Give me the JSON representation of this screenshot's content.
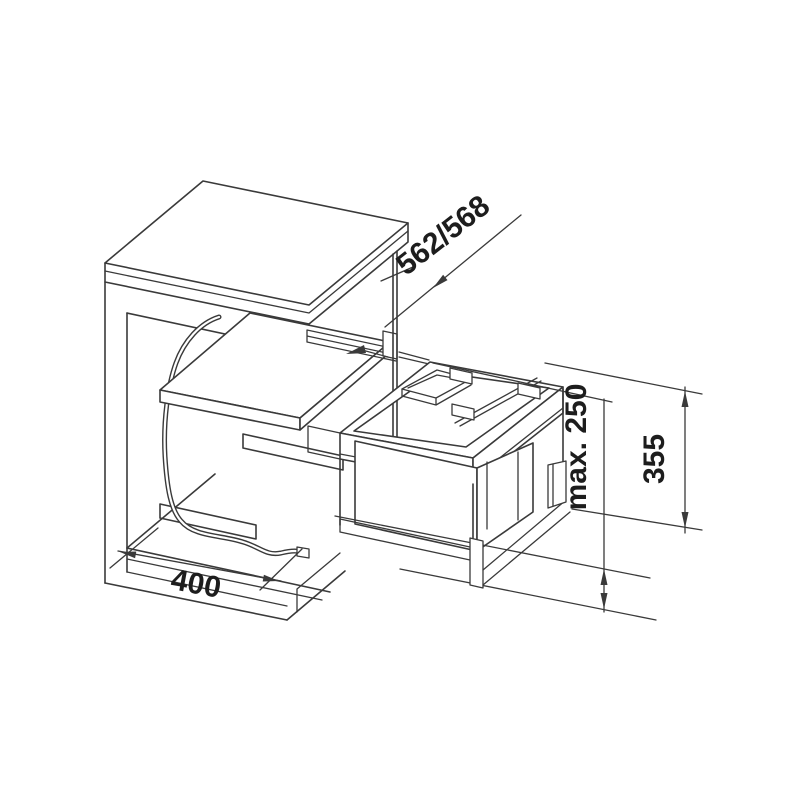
{
  "meta": {
    "background_color": "#ffffff",
    "line_color": "#3a3a3a",
    "text_color": "#1d1d1d",
    "drawing_type": "isometric technical drawing",
    "subject": "kitchen base cabinet with pull-out waste bin system"
  },
  "dimensions": {
    "depth_label": "562/568",
    "height_label": "355",
    "max_label": "max. 250",
    "width_label": "400"
  }
}
